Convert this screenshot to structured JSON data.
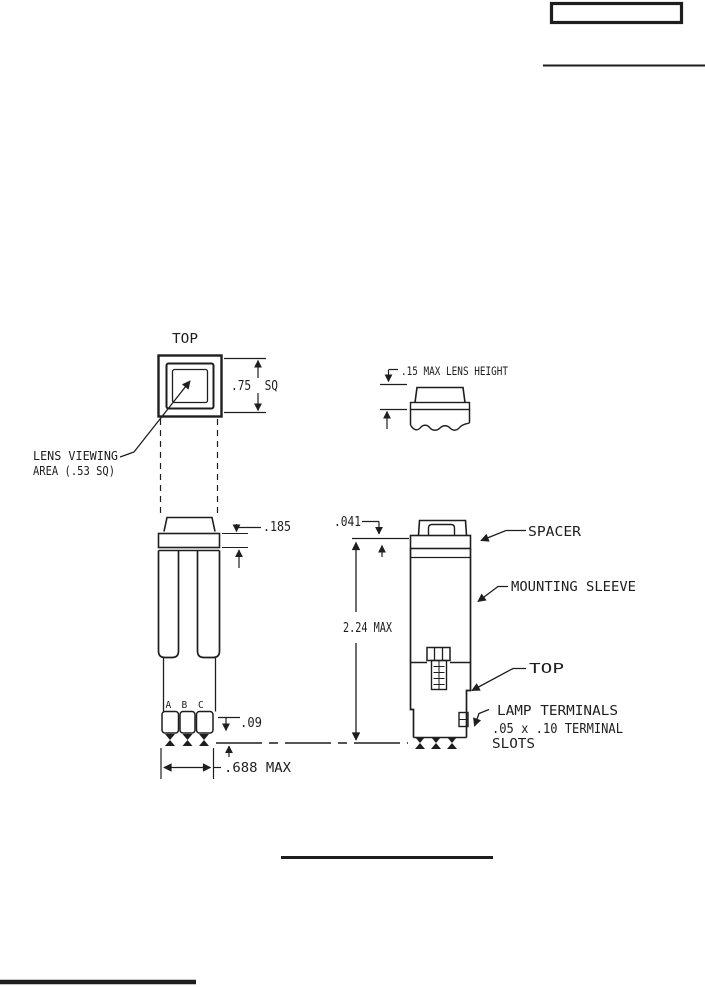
{
  "colors": {
    "ink": "#1e1e1e",
    "paper": "#ffffff"
  },
  "left_view": {
    "title": "TOP",
    "lens_label_line1": "LENS VIEWING",
    "lens_label_line2": "AREA (.53 SQ)",
    "dim_lens_square": ".75  SQ",
    "dim_spacer_thickness": ".185",
    "terminal_a": "A",
    "terminal_b": "B",
    "terminal_c": "C",
    "dim_terminal_protrusion": ".09",
    "dim_body_width": ".688 MAX"
  },
  "lens_detail": {
    "dim_lens_height": ".15 MAX LENS HEIGHT"
  },
  "right_view": {
    "dim_spacer_gap": ".041",
    "dim_overall_height": "2.24 MAX",
    "label_spacer": "SPACER",
    "label_mounting_sleeve": "MOUNTING SLEEVE",
    "label_top": "TOP",
    "label_lamp_terminals_line1": "LAMP TERMINALS",
    "label_lamp_terminals_line2": ".05 x .10 TERMINAL",
    "label_lamp_terminals_line3": "SLOTS"
  }
}
